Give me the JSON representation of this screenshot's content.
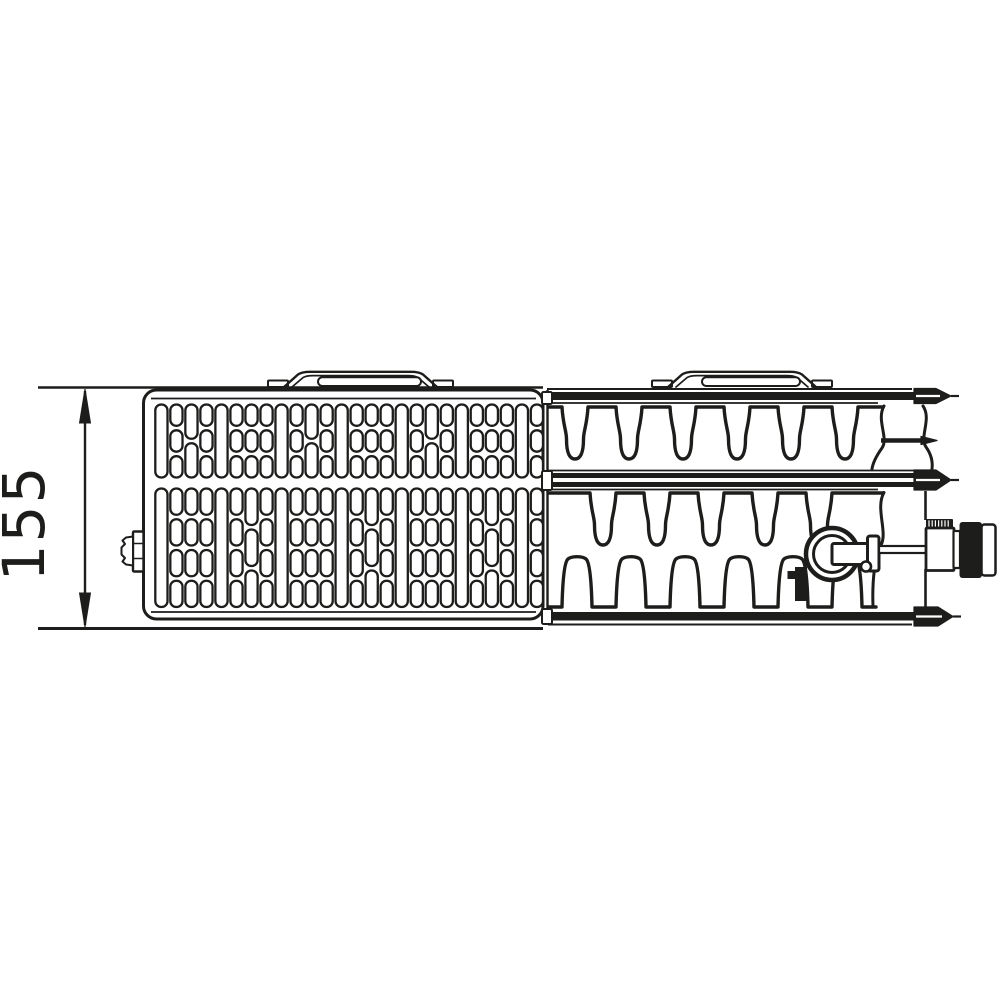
{
  "diagram": {
    "kind": "panel-radiator-top-view-technical-drawing",
    "background": "#ffffff",
    "line_color": "#1d1d1b",
    "dimension": {
      "label": "155",
      "orientation": "vertical"
    }
  }
}
